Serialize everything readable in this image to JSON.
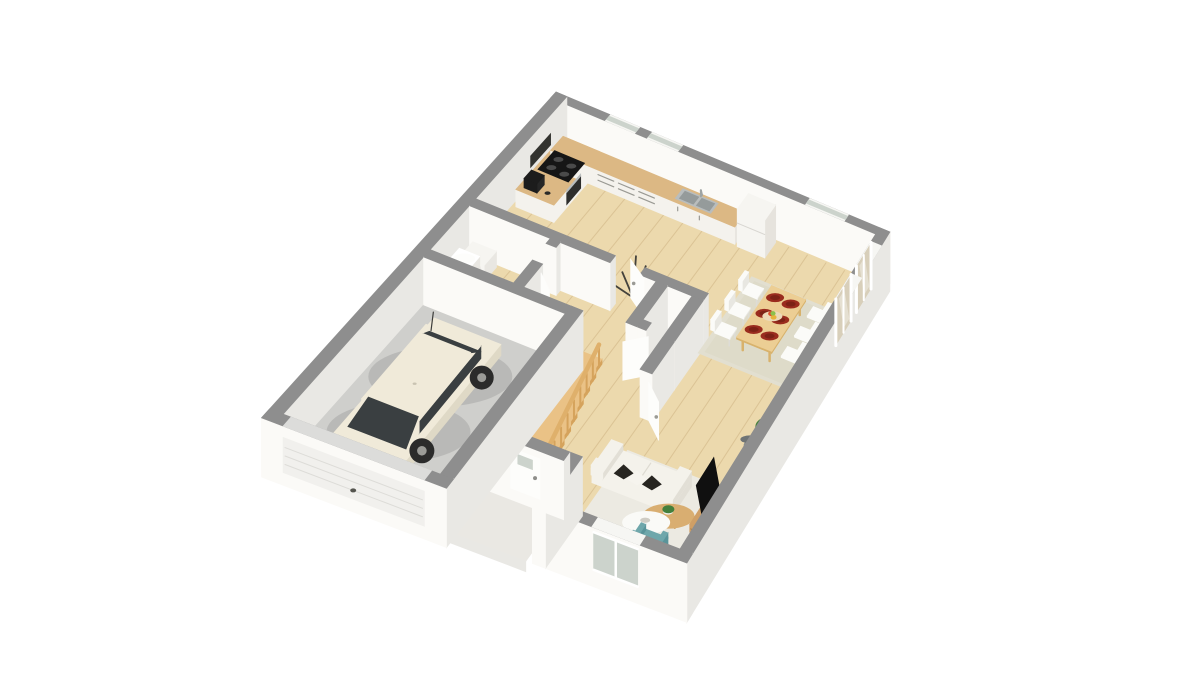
{
  "scene": {
    "kind": "isometric-3d-floorplan",
    "background": "#ffffff",
    "floor_shown": "ground-floor"
  },
  "rooms": [
    {
      "name": "kitchen"
    },
    {
      "name": "dining-area"
    },
    {
      "name": "living-room"
    },
    {
      "name": "hallway"
    },
    {
      "name": "wc"
    },
    {
      "name": "utility-room"
    },
    {
      "name": "garage"
    },
    {
      "name": "entry-porch"
    }
  ],
  "objects": [
    "white-compact-car",
    "garage-door",
    "front-door",
    "wood-staircase",
    "stair-railing",
    "kitchen-counter",
    "cooktop",
    "oven",
    "coffee-machine",
    "kitchen-sink",
    "fridge",
    "washing-machine",
    "water-heater",
    "dining-table",
    "dining-chairs",
    "dinner-plates",
    "fruit-bowl",
    "dining-rug",
    "sofa",
    "pillows",
    "coffee-table",
    "side-table",
    "tv",
    "tv-stand",
    "teal-armchair",
    "living-rug",
    "floor-lamp",
    "potted-plant",
    "tree-decal",
    "sliding-glass-doors",
    "windows",
    "interior-doors"
  ],
  "palette": {
    "wallCap": "#8e8e8e",
    "wallFace": "#fbfaf7",
    "wallFaceShade": "#e9e8e4",
    "floorWood": "#ecd9ad",
    "floorWoodLine": "rgba(176,140,86,0.28)",
    "garageFloor": "#cfcfcc",
    "porch": "#eae8e3",
    "counterWood": "#dcb884",
    "cabinet": "#f4f2ed",
    "cabinetShade": "#e6e3dd",
    "handle": "#9a9a94",
    "steel": "#b9bdbd",
    "steelDark": "#959b9b",
    "black": "#161616",
    "stairWood": "#eac286",
    "stairWoodSide": "#d5a35c",
    "stairRail": "#dfb06b",
    "tableWood": "#ecce94",
    "tableWoodSide": "#d8b26c",
    "chair": "#fbfbf8",
    "chairShade": "#e8e7e1",
    "plate": "#9a2c1e",
    "plateDark": "#7c2216",
    "fruitBowl": "#ecd9b8",
    "rugDining": "#e2dfd0",
    "rugLiving": "#eceae2",
    "sofa": "#f4f2eb",
    "sofaShade": "#e2dfd6",
    "pillowDark": "#272520",
    "armchair": "#6fa7ab",
    "armchairDark": "#5a949a",
    "tv": "#101010",
    "tvStand": "#cf9f66",
    "coffeeTable": "#d9ae71",
    "sideTable": "#fafaf7",
    "plantGreen": "#44803c",
    "plantDark": "#2f6330",
    "pot": "#f1f0ec",
    "lampShade": "#878c8d",
    "lampPole": "#c9c7c1",
    "carBody": "#f0ead9",
    "carShade": "#dfd9c6",
    "carGlass": "#3a3f41",
    "carWheel": "#2b2b2b",
    "applianceWhite": "#f6f5f1",
    "glassPane": "#ccd3cc",
    "glassExt": "#d8cfba",
    "windowFrame": "#f6f6f3",
    "door": "#fdfdfb",
    "decal": "#44423c",
    "shadow": "rgba(0,0,0,0.10)"
  }
}
